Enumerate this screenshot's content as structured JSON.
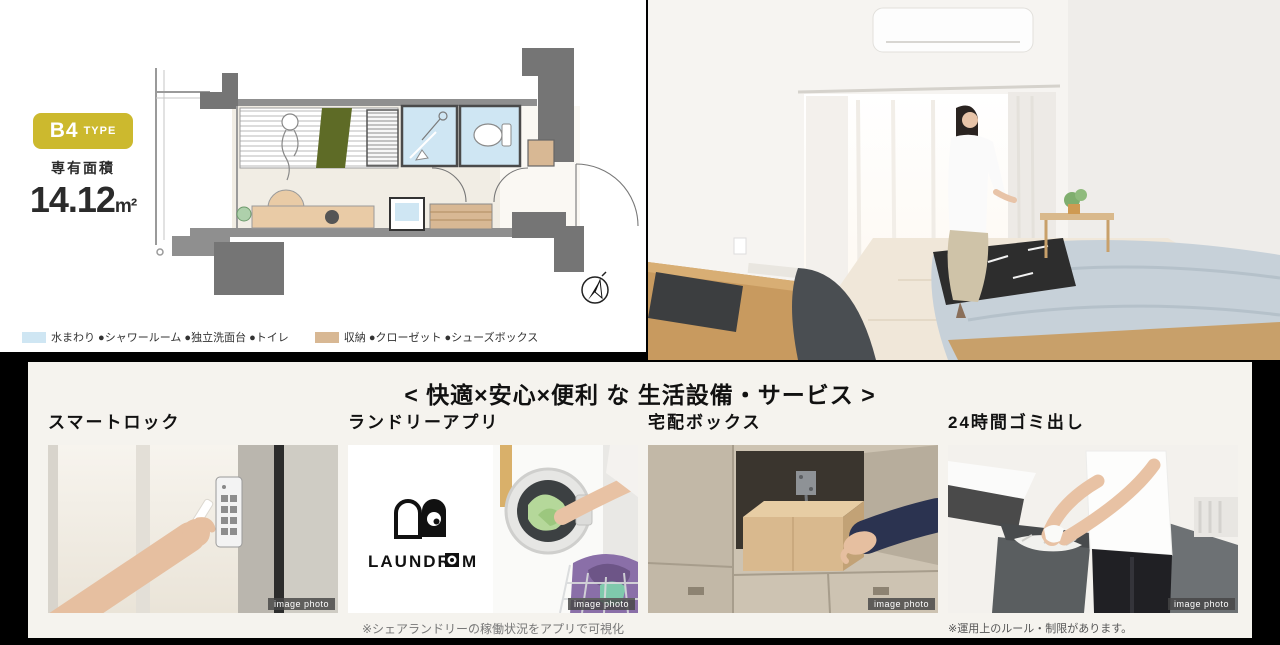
{
  "colors": {
    "page_bg": "#000000",
    "left_panel_bg": "#ffffff",
    "bottom_panel_bg": "#f5f3ee",
    "badge_bg": "#ccb92e",
    "wet_area_blue": "#cfe6f3",
    "storage_tan": "#d8b894",
    "blanket_green": "#5e6b26"
  },
  "floorplan_panel": {
    "type_badge": {
      "name": "B4",
      "suffix": "TYPE"
    },
    "area": {
      "label": "専有面積",
      "value": "14.12",
      "unit": "m²"
    },
    "legend": [
      {
        "label": "水まわり ●シャワールーム ●独立洗面台 ●トイレ"
      },
      {
        "label": "収納 ●クローゼット ●シューズボックス"
      }
    ]
  },
  "services_panel": {
    "heading": "< 快適×安心×便利 な 生活設備・サービス >",
    "items": [
      {
        "title": "スマートロック",
        "watermark": "image photo"
      },
      {
        "title": "ランドリーアプリ",
        "watermark": "image photo",
        "logo_left": "LAUNDR",
        "logo_right": "M",
        "caption": "※シェアランドリーの稼働状況をアプリで可視化"
      },
      {
        "title": "宅配ボックス",
        "watermark": "image photo"
      },
      {
        "title": "24時間ゴミ出し",
        "watermark": "image photo",
        "caption": "※運用上のルール・制限があります。"
      }
    ]
  }
}
